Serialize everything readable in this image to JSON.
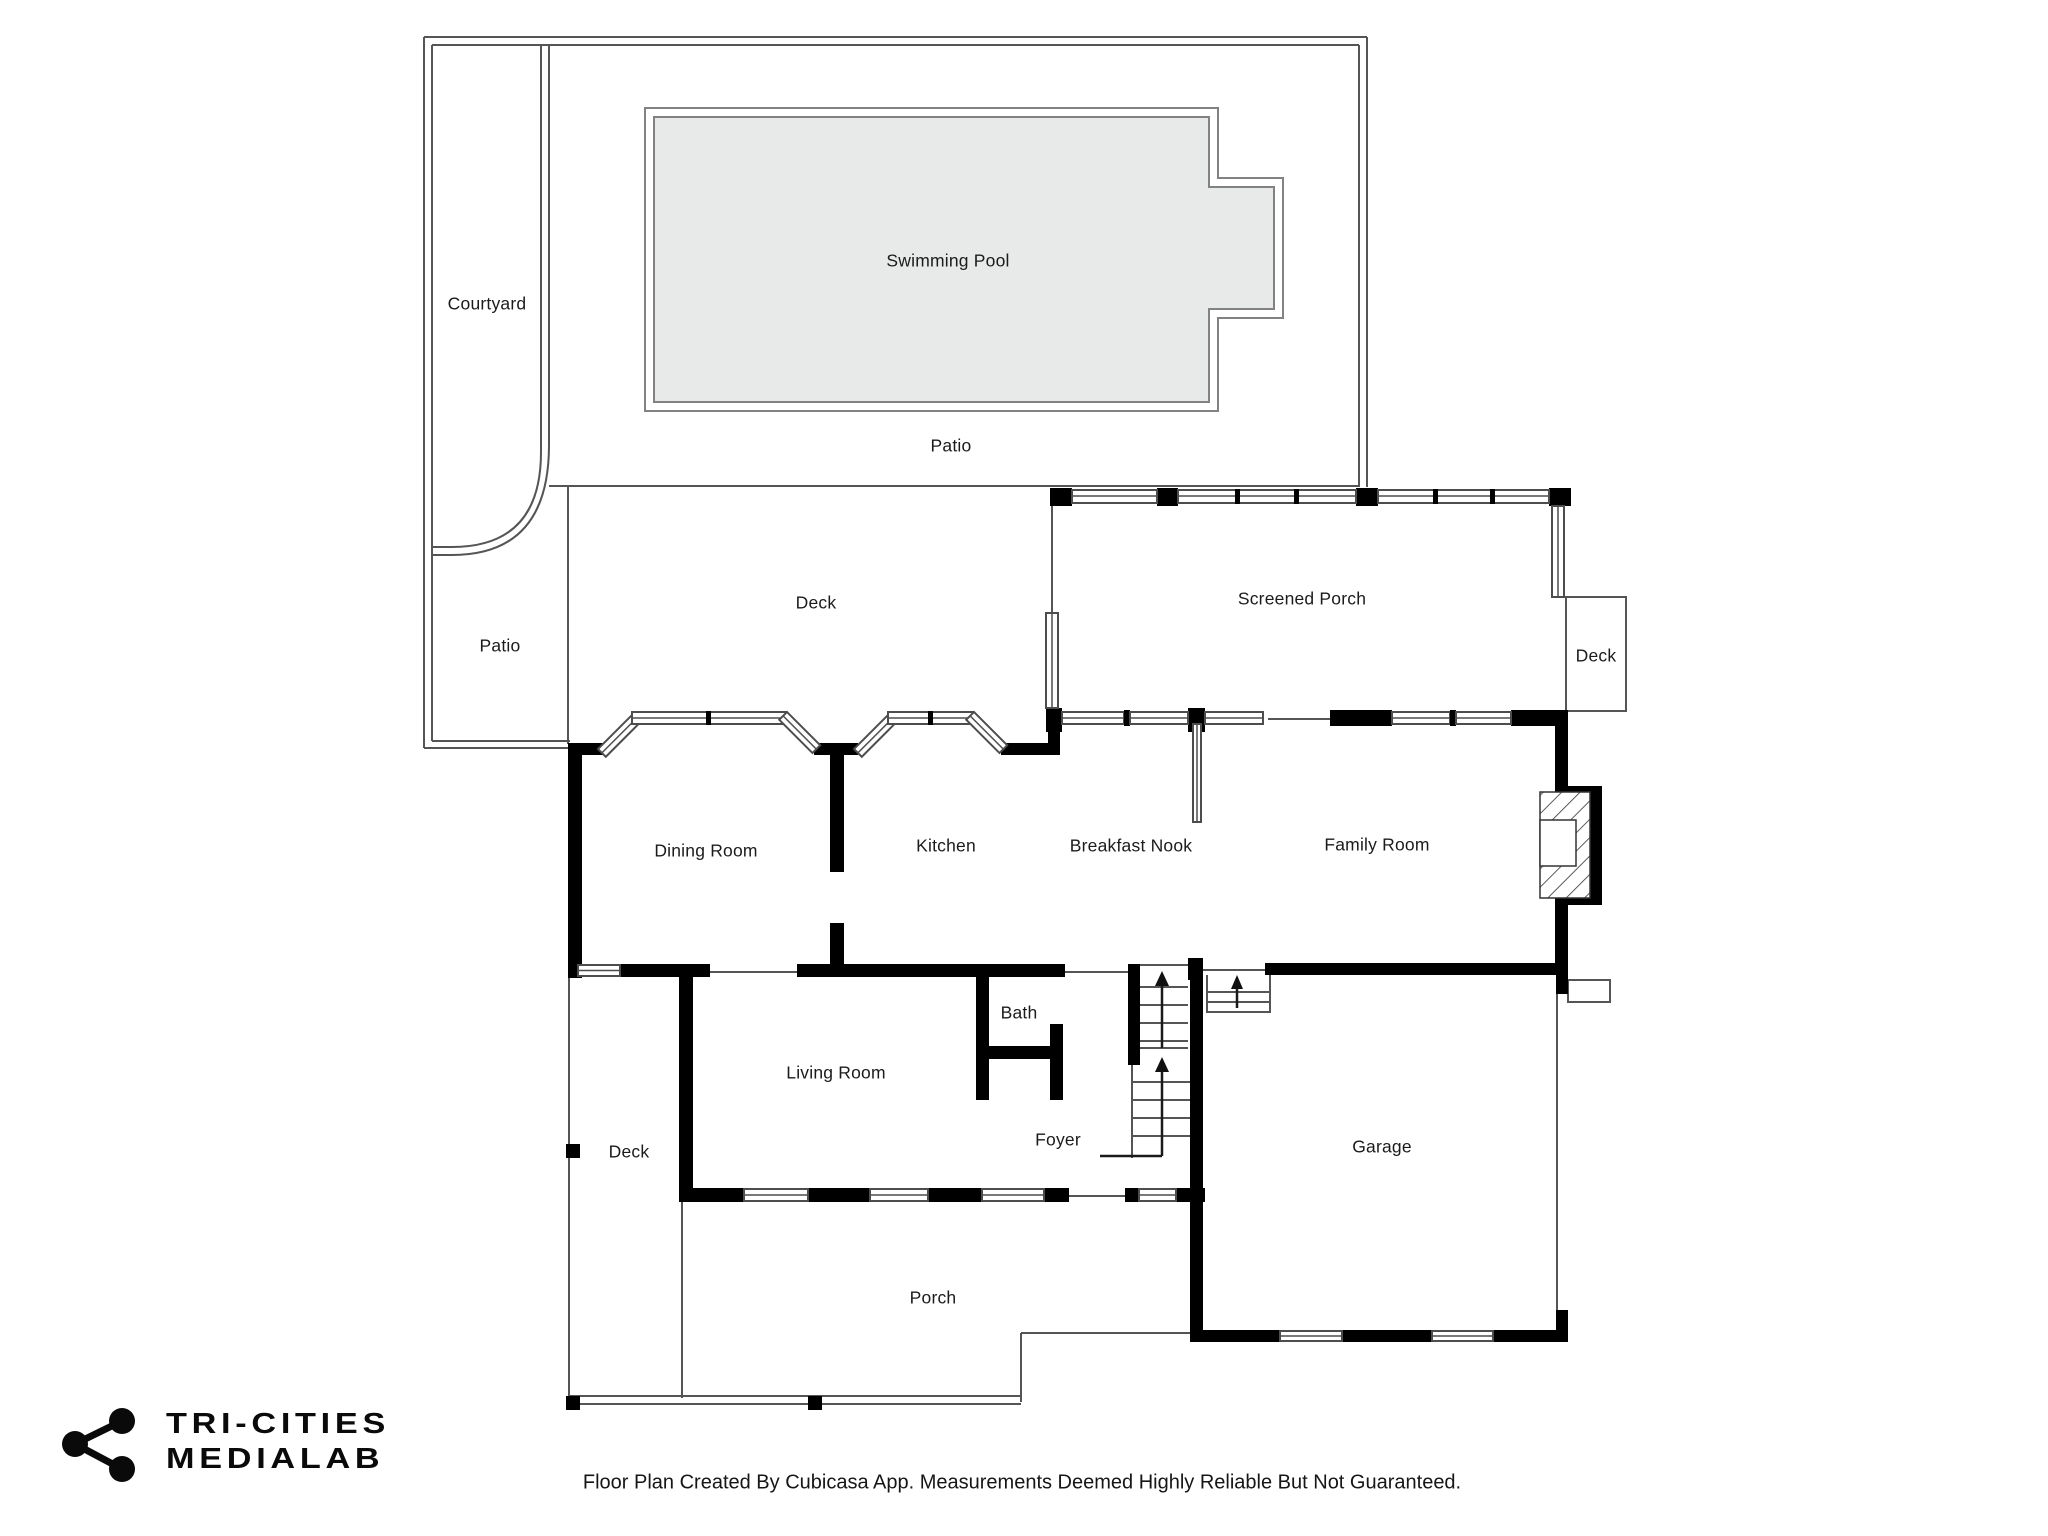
{
  "labels": {
    "courtyard": "Courtyard",
    "swimming_pool": "Swimming Pool",
    "patio_top": "Patio",
    "patio_left": "Patio",
    "deck_top": "Deck",
    "screened_porch": "Screened Porch",
    "deck_right": "Deck",
    "dining_room": "Dining Room",
    "kitchen": "Kitchen",
    "breakfast_nook": "Breakfast Nook",
    "family_room": "Family Room",
    "bath": "Bath",
    "living_room": "Living Room",
    "foyer": "Foyer",
    "garage": "Garage",
    "deck_left": "Deck",
    "porch": "Porch"
  },
  "branding": {
    "logo_line1": "TRI-CITIES",
    "logo_line2": "MEDIALAB"
  },
  "footer": {
    "disclaimer": "Floor Plan Created By Cubicasa App. Measurements Deemed Highly Reliable But Not Guaranteed."
  },
  "colors": {
    "wall": "#000000",
    "outline": "#555555",
    "pool_fill": "#e8e9e9",
    "pool_line": "#828282",
    "text": "#1b1b1b"
  }
}
